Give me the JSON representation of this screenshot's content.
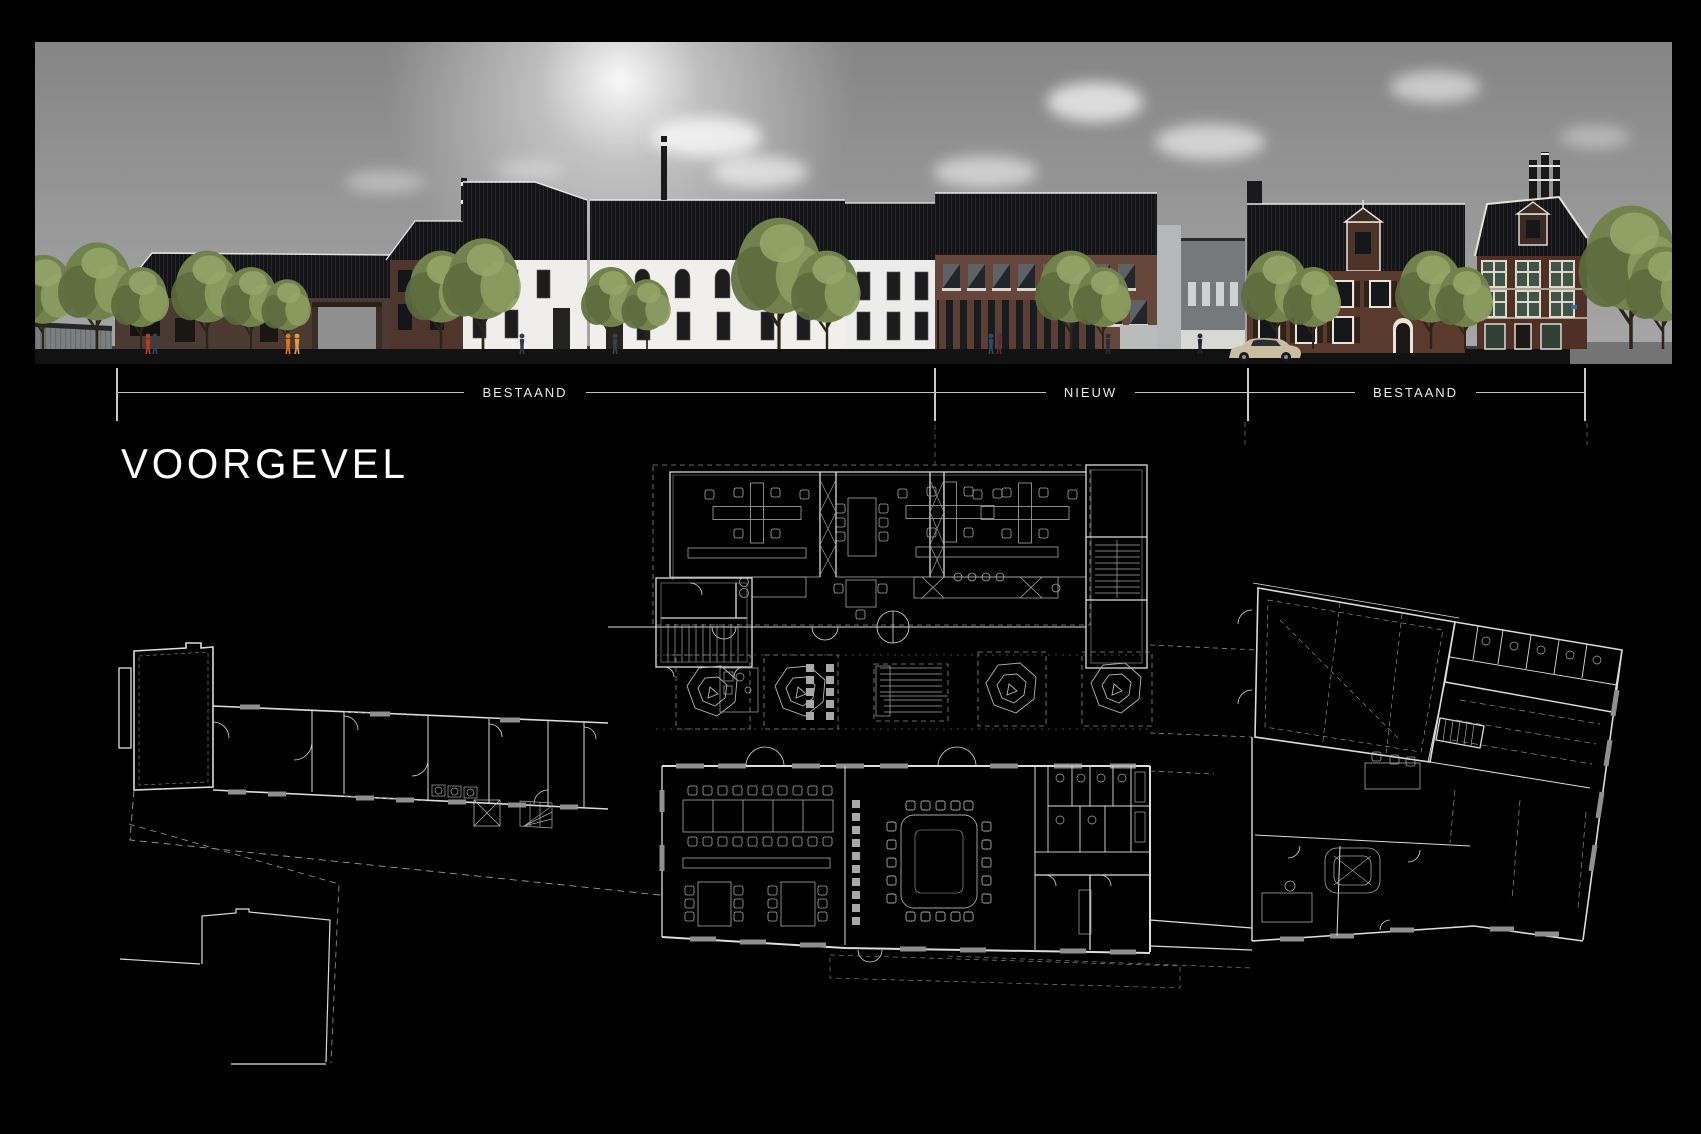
{
  "page": {
    "title": "VOORGEVEL"
  },
  "dimension_bar": {
    "segments": [
      {
        "label": "BESTAAND"
      },
      {
        "label": "NIEUW"
      },
      {
        "label": "BESTAAND"
      }
    ]
  },
  "colors": {
    "background": "#000000",
    "plan_line": "#dcdcdc",
    "plan_dashed": "#7f7f7f",
    "dimension_line": "#c2c2c2",
    "sky_top": "#858585",
    "sky_bottom": "#a8a8a8",
    "roof_black": "#141417",
    "white_facade": "#efeeea",
    "warehouse_brick": "#4b3a31",
    "nieuw_brick": "#66453a",
    "historic_brick": "#5a3a2c",
    "mansion_brick": "#4f3026",
    "grey_infill": "#75797b",
    "tree_green": "#72824c",
    "street_dark": "#121212",
    "street_light": "#747474",
    "accent_orange": "#e07820"
  }
}
